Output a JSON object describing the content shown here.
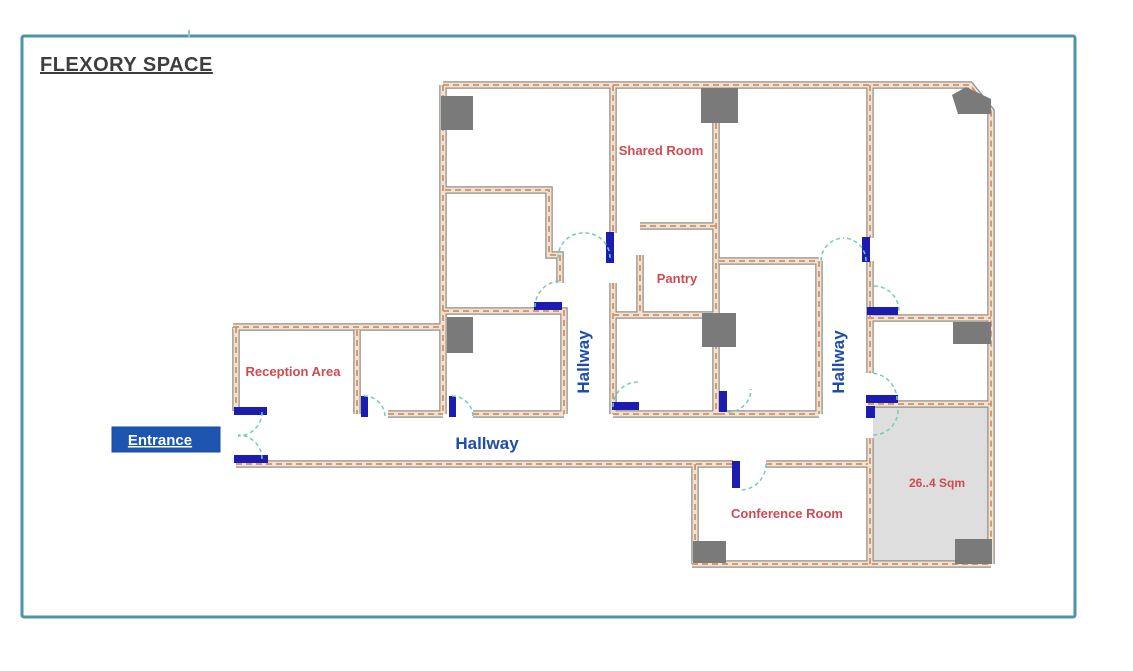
{
  "window": {
    "title": "FLEXORY SPACE"
  },
  "floorplan": {
    "rooms": [
      {
        "name": "Reception Area"
      },
      {
        "name": "Shared Room"
      },
      {
        "name": "Pantry"
      },
      {
        "name": "Conference Room"
      }
    ],
    "area_label": "26..4 Sqm",
    "hallway_labels": {
      "horizontal": "Hallway",
      "vertical_left": "Hallway",
      "vertical_right": "Hallway"
    },
    "entrance_label": "Entrance",
    "colors": {
      "border": "#4e93a7",
      "title": "#3d3d3d",
      "wall_edge": "#8f8f8f",
      "wall_fill": "#f3e2cd",
      "wall_hatch": "#d2916a",
      "door": "#1c1cb0",
      "door_swing": "#74cdb8",
      "column": "#7a7a7a",
      "room_label": "#cf4a52",
      "hallway_label": "#1f4da8",
      "entrance_bg": "#1d55b0",
      "entrance_text": "#ffffff",
      "shaded_room_fill": "#dedede"
    }
  }
}
